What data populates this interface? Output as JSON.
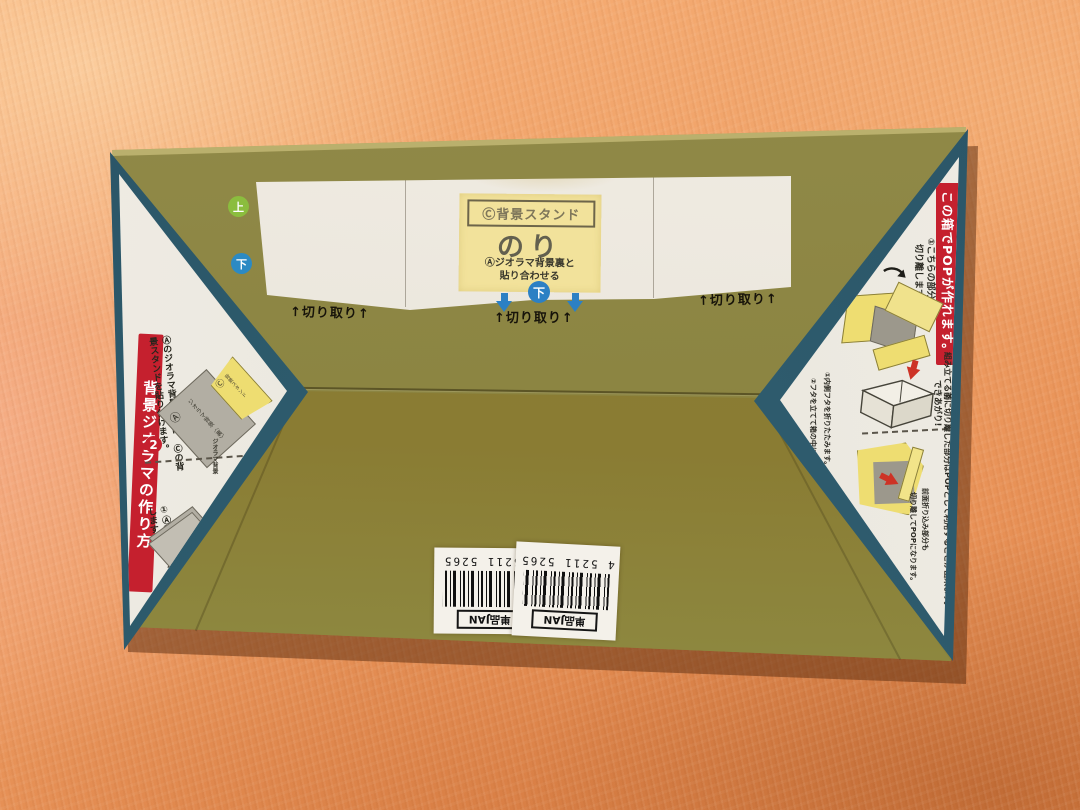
{
  "box": {
    "orientation": {
      "up": "上",
      "down": "下",
      "down_center": "下"
    },
    "glue_panel": {
      "header": "Ⓒ背景スタンド",
      "title": "のり",
      "note_line1": "Ⓐジオラマ背景裏と",
      "note_line2": "貼り合わせる"
    },
    "cut_label": "↑切り取り↑",
    "left_flap": {
      "banner": "背景ジオラマの作り方",
      "step2": {
        "num": "2",
        "line1": "Ⓐのジオラマ背景の裏に",
        "line2": "Ⓒの背景スタンドを貼り付けます。"
      },
      "diagram": {
        "bg_label": "Ⓐ",
        "bg_caption": "ジオラマ背景〈裏〉",
        "stand_label": "Ⓒ",
        "stand_caption": "背景スタンド",
        "page_caption": "ジオラマ背景"
      },
      "step1": {
        "line1": "①ⒶⒷⒸ",
        "line2": "のページを切り離します。"
      }
    },
    "right_flap": {
      "banner": "この箱でPOPが作れます。",
      "step1": {
        "line1": "①こちらの部分は",
        "line2": "切り離します。"
      },
      "step2_num": "②",
      "done": "できあがり!",
      "caption1": "①内側フタを折りたたみます。",
      "caption2": "②フタを立てて箱の中に差し込みます。",
      "note_long": "組み立てる前に切り離した部分はPOPとして利用することが出来ます。",
      "note_front_line1": "前面折り込み部分も",
      "note_front_line2": "切り離してPOPになります。"
    },
    "barcode": {
      "label": "単品JAN",
      "digits": "4 5211   5265"
    }
  },
  "colors": {
    "olive_top": "#8b8441",
    "olive_bottom": "#8a7c33",
    "teal_edge": "#2d5a6c",
    "banner_red": "#c5202e",
    "arrow_blue": "#2c80c4",
    "up_green": "#8bbd3e",
    "glue_yellow": "#f2e29b",
    "panel_white": "#ece8df",
    "blanket_orange": "#efa066"
  }
}
